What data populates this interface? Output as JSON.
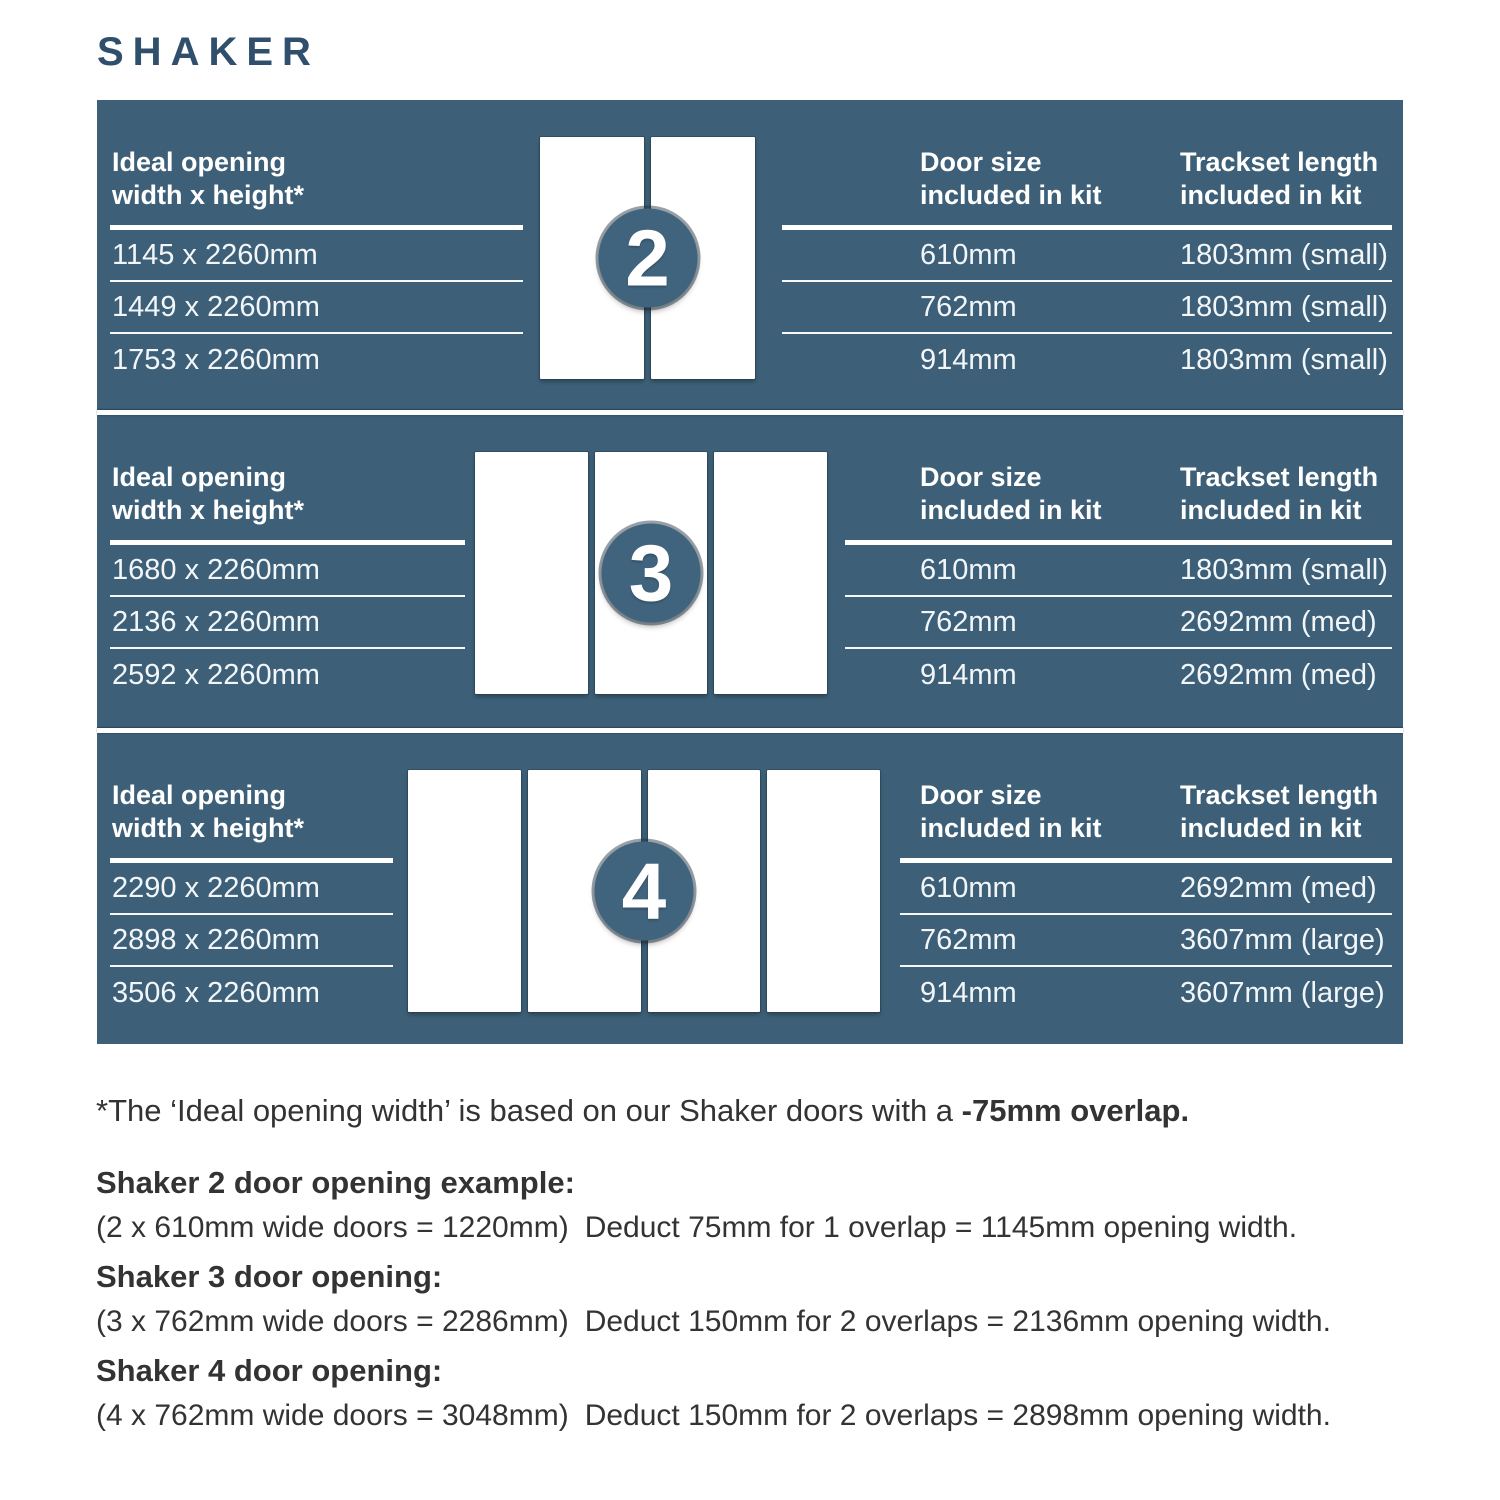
{
  "title": "SHAKER",
  "colors": {
    "panel_background": "#3d6078",
    "badge_background": "#41647e",
    "title_color": "#2f4f6c",
    "body_text": "#333333",
    "table_text": "#ffffff"
  },
  "sections": [
    {
      "door_count": "2",
      "opening_header": "Ideal opening\nwidth x height*",
      "openings": [
        "1145 x 2260mm",
        "1449 x 2260mm",
        "1753 x 2260mm"
      ],
      "door_size_header": "Door size\nincluded in kit",
      "trackset_header": "Trackset length\nincluded in kit",
      "rows": [
        {
          "door_size": "610mm",
          "trackset": "1803mm (small)"
        },
        {
          "door_size": "762mm",
          "trackset": "1803mm (small)"
        },
        {
          "door_size": "914mm",
          "trackset": "1803mm (small)"
        }
      ]
    },
    {
      "door_count": "3",
      "opening_header": "Ideal opening\nwidth x height*",
      "openings": [
        "1680 x 2260mm",
        "2136 x 2260mm",
        "2592 x 2260mm"
      ],
      "door_size_header": "Door size\nincluded in kit",
      "trackset_header": "Trackset length\nincluded in kit",
      "rows": [
        {
          "door_size": "610mm",
          "trackset": "1803mm (small)"
        },
        {
          "door_size": "762mm",
          "trackset": "2692mm (med)"
        },
        {
          "door_size": "914mm",
          "trackset": "2692mm (med)"
        }
      ]
    },
    {
      "door_count": "4",
      "opening_header": "Ideal opening\nwidth x height*",
      "openings": [
        "2290 x 2260mm",
        "2898 x 2260mm",
        "3506 x 2260mm"
      ],
      "door_size_header": "Door size\nincluded in kit",
      "trackset_header": "Trackset length\nincluded in kit",
      "rows": [
        {
          "door_size": "610mm",
          "trackset": "2692mm (med)"
        },
        {
          "door_size": "762mm",
          "trackset": "3607mm (large)"
        },
        {
          "door_size": "914mm",
          "trackset": "3607mm (large)"
        }
      ]
    }
  ],
  "footnote": {
    "regular": "*The ‘Ideal opening width’ is based on our Shaker doors with a ",
    "bold": "-75mm overlap."
  },
  "examples": [
    {
      "heading": "Shaker 2 door opening example:",
      "calc": "(2 x 610mm wide doors = 1220mm)",
      "deduction": "Deduct 75mm for 1 overlap = 1145mm opening width."
    },
    {
      "heading": "Shaker 3 door opening:",
      "calc": "(3 x 762mm wide doors = 2286mm)",
      "deduction": "Deduct 150mm for 2 overlaps = 2136mm opening width."
    },
    {
      "heading": "Shaker 4 door opening:",
      "calc": "(4 x 762mm wide doors = 3048mm)",
      "deduction": "Deduct 150mm for 2 overlaps = 2898mm opening width."
    }
  ]
}
